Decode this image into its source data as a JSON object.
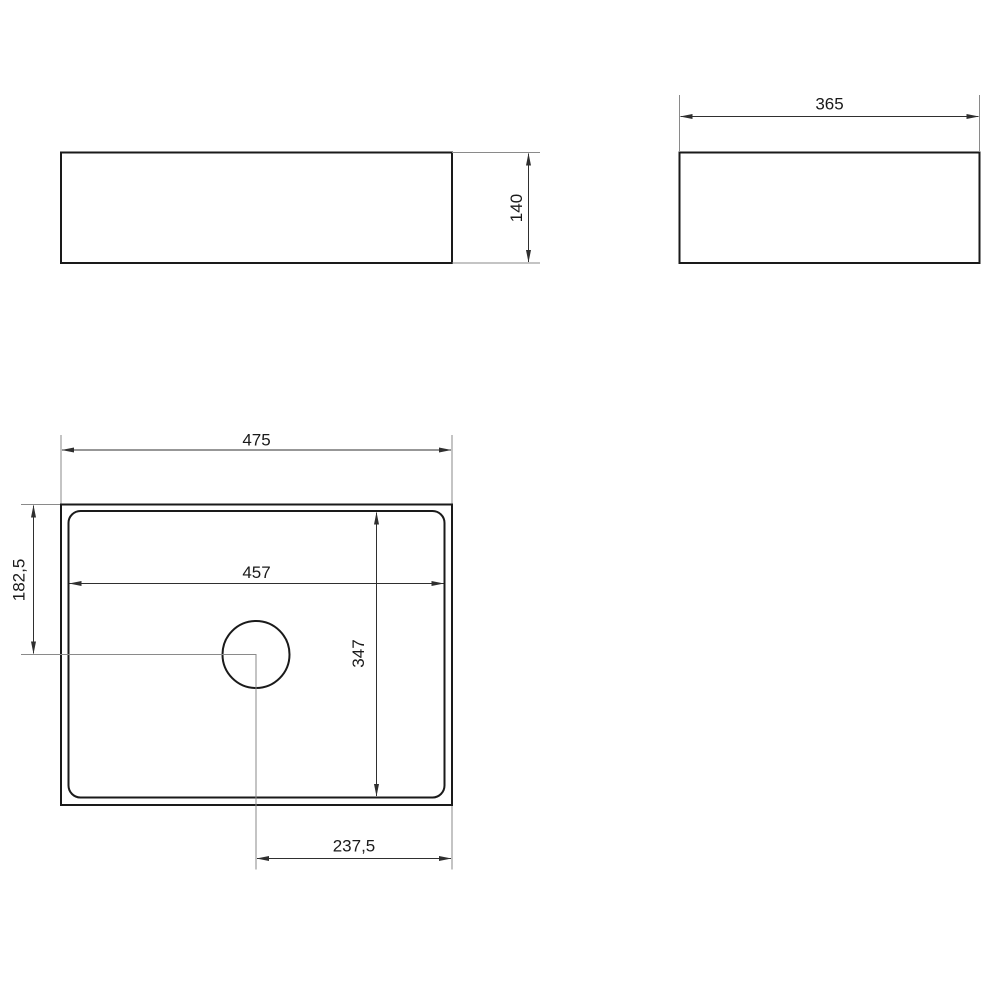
{
  "colors": {
    "object_line": "#1a1a1a",
    "dimension_line": "#2f2f2f",
    "extension_line": "#8a8a8a",
    "text_color": "#1a1a1a",
    "background": "#ffffff"
  },
  "dims": {
    "front_height": "140",
    "side_width": "365",
    "plan_width": "475",
    "basin_width": "457",
    "hole_offset_y": "182,5",
    "basin_depth": "347",
    "hole_offset_x": "237,5"
  }
}
